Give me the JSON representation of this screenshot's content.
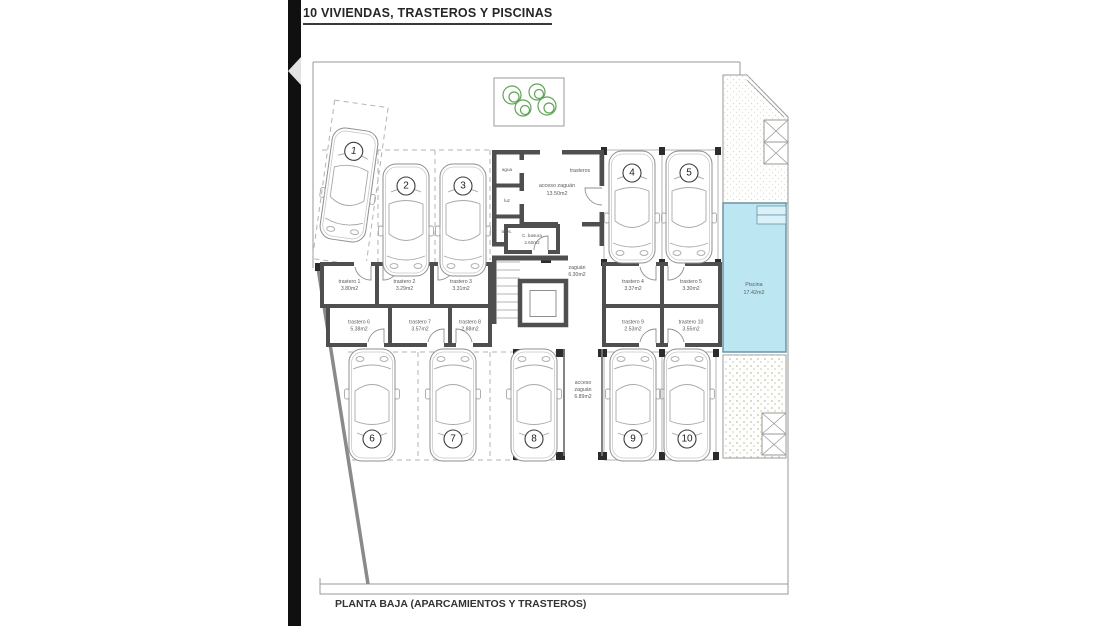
{
  "title": "10 VIVIENDAS, TRASTEROS Y PISCINAS",
  "caption": "PLANTA BAJA (APARCAMIENTOS Y TRASTEROS)",
  "rooms": {
    "entry_note": "trasteros",
    "entry": {
      "name": "acceso zaguán",
      "area": "13.50m2"
    },
    "utilities": [
      {
        "label": "agua"
      },
      {
        "label": "luz"
      },
      {
        "label": "telec."
      }
    ],
    "basura": {
      "name": "C. basura",
      "area": "2.60m2"
    },
    "hall": {
      "name": "zaguán",
      "area": "6.30m2"
    },
    "corridor": {
      "lines": [
        "acceso",
        "zaguán",
        "6.89m2"
      ]
    },
    "pool": {
      "name": "Piscina",
      "area": "17.42m2"
    }
  },
  "storerooms": [
    {
      "name": "trastero 1",
      "area": "3.80m2"
    },
    {
      "name": "trastero 2",
      "area": "3.29m2"
    },
    {
      "name": "trastero 3",
      "area": "3.31m2"
    },
    {
      "name": "trastero 4",
      "area": "3.37m2"
    },
    {
      "name": "trastero 5",
      "area": "3.30m2"
    },
    {
      "name": "trastero 6",
      "area": "5.38m2"
    },
    {
      "name": "trastero 7",
      "area": "3.57m2"
    },
    {
      "name": "trastero 8",
      "area": "2.88m2"
    },
    {
      "name": "trastero 9",
      "area": "2.53m2"
    },
    {
      "name": "trastero 10",
      "area": "3.55m2"
    }
  ],
  "parking_spots": [
    {
      "number": "1"
    },
    {
      "number": "2"
    },
    {
      "number": "3"
    },
    {
      "number": "4"
    },
    {
      "number": "5"
    },
    {
      "number": "6"
    },
    {
      "number": "7"
    },
    {
      "number": "8"
    },
    {
      "number": "9"
    },
    {
      "number": "10"
    }
  ],
  "colors": {
    "pool": "#bce7f2",
    "terrace": "#f0efe3",
    "garden": "#f2f3e4",
    "tree": "#5fa457",
    "wall": "#4f4f4f"
  }
}
